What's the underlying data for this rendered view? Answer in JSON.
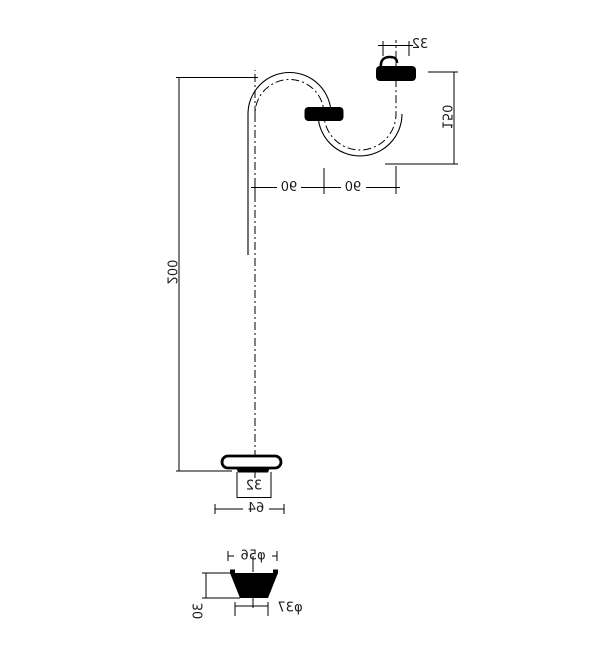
{
  "drawing": {
    "kind": "plumbing-s-trap-technical-drawing-mirrored",
    "colors": {
      "line": "#000000",
      "text": "#1c1c1c",
      "background": "#ffffff",
      "solid_fill": "#000000"
    },
    "dims": {
      "outlet_diameter": "32",
      "outlet_height": "150",
      "span_left": "90",
      "span_right": "90",
      "tailpipe_length": "200",
      "tailpipe_diameter": "32",
      "flange_width": "64",
      "plug_top_diameter": "φ56",
      "plug_height": "30",
      "plug_bottom_diameter": "φ37"
    }
  }
}
